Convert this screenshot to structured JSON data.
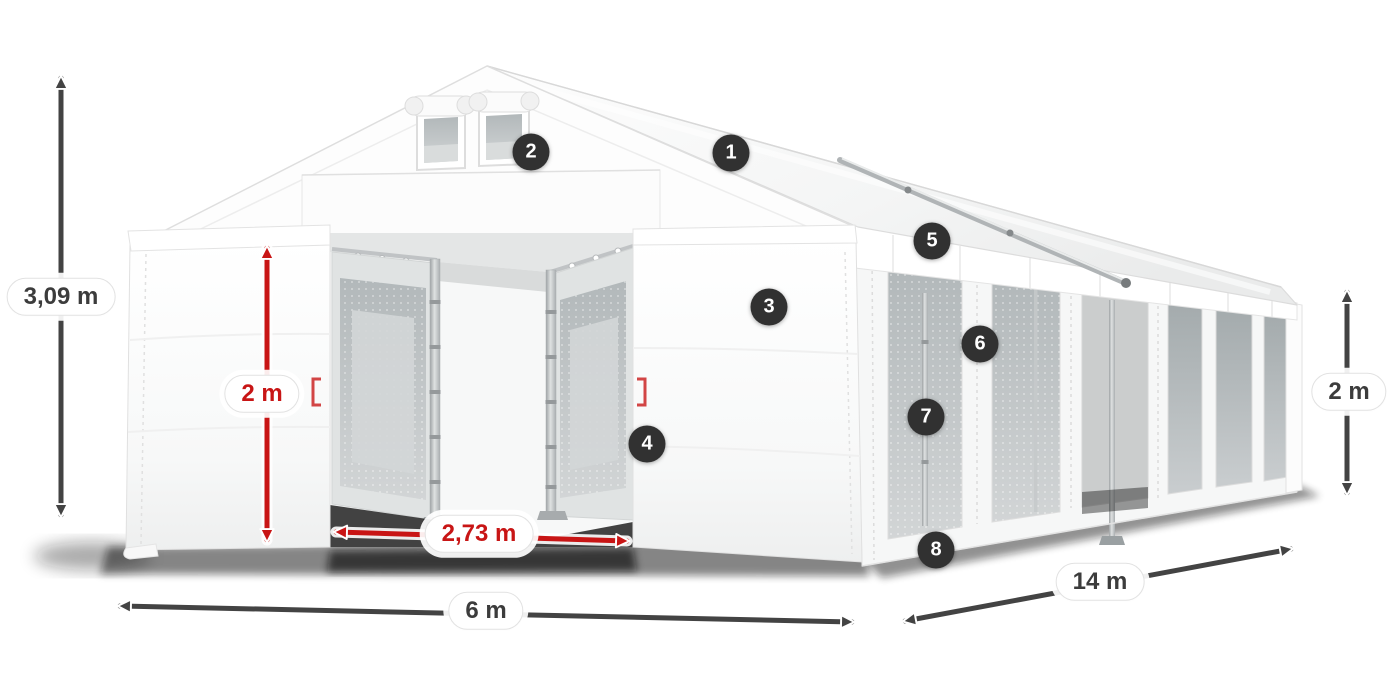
{
  "product_diagram": {
    "subject": "party-tent-dimension-illustration",
    "dimensions": {
      "total_height": {
        "label": "3,09 m",
        "style": "dark",
        "orientation": "vertical",
        "side": "left"
      },
      "entrance_height": {
        "label": "2 m",
        "style": "red",
        "orientation": "vertical",
        "side": "front-entrance"
      },
      "entrance_width": {
        "label": "2,73 m",
        "style": "red",
        "orientation": "horizontal",
        "side": "front-entrance"
      },
      "front_width": {
        "label": "6 m",
        "style": "dark",
        "orientation": "horizontal",
        "side": "front-bottom"
      },
      "side_length": {
        "label": "14 m",
        "style": "dark",
        "orientation": "diagonal",
        "side": "right-bottom"
      },
      "side_wall_height": {
        "label": "2 m",
        "style": "dark",
        "orientation": "vertical",
        "side": "right"
      }
    },
    "callouts": [
      {
        "number": "1",
        "target": "roof"
      },
      {
        "number": "2",
        "target": "gable-vent-windows"
      },
      {
        "number": "3",
        "target": "front-wall-panel"
      },
      {
        "number": "4",
        "target": "entrance-door-edge"
      },
      {
        "number": "5",
        "target": "side-eave-band"
      },
      {
        "number": "6",
        "target": "side-wall-mullion"
      },
      {
        "number": "7",
        "target": "inner-frame-pole"
      },
      {
        "number": "8",
        "target": "side-wall-skirt"
      }
    ],
    "colors": {
      "background": "#ffffff",
      "tent_white": "#fdfdfd",
      "tent_shade": "#f1f2f2",
      "window_gray": "#a4abad",
      "mesh_gray": "#b8bdbf",
      "frame_silver": "#b5b9bb",
      "dark_arrow": "#434343",
      "red_arrow": "#c81515",
      "badge_bg": "#313131",
      "badge_text": "#ffffff",
      "pill_bg": "#ffffff",
      "pill_border": "#e2e2e2",
      "dark_text": "#3c3c3c",
      "red_text": "#c81515",
      "shadow": "#111111"
    }
  }
}
